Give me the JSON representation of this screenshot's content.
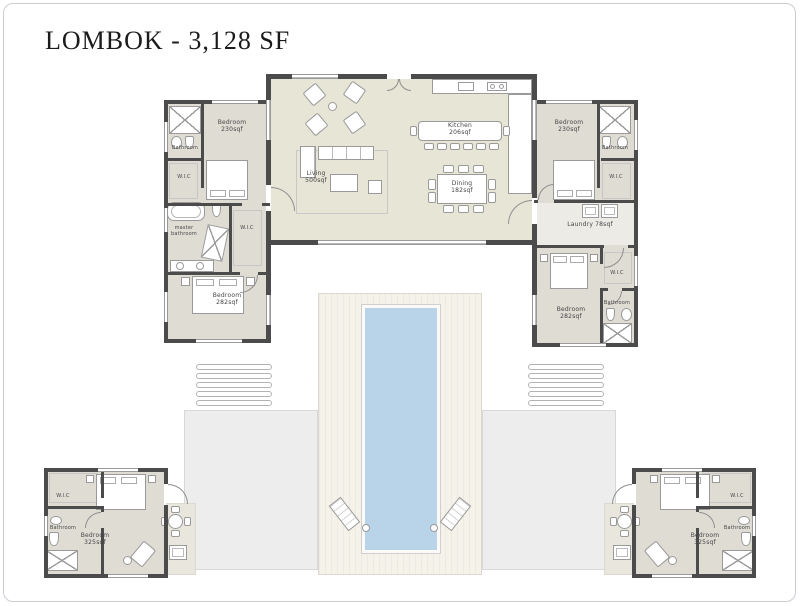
{
  "title": "LOMBOK - 3,128 SF",
  "colors": {
    "wall": "#4b4b4b",
    "great_room_floor": "#e6e5d6",
    "wing_floor": "#dfdcd4",
    "pool_water": "#b9d3e9",
    "deck": "#f5f2ea",
    "patio": "#ededed",
    "label_text": "#454545"
  },
  "rooms": {
    "bedroom_tl": {
      "name": "Bedroom",
      "area": "230sqf"
    },
    "bathroom_tl": {
      "name": "Bathroom"
    },
    "wic_tl": {
      "name": "W.I.C"
    },
    "master_bathroom": {
      "name": "master bathroom"
    },
    "wic_master": {
      "name": "W.I.C"
    },
    "bedroom_bl": {
      "name": "Bedroom",
      "area": "282sqf"
    },
    "living": {
      "name": "Living",
      "area": "500sqf"
    },
    "kitchen": {
      "name": "Kitchen",
      "area": "206sqf"
    },
    "dining": {
      "name": "Dining",
      "area": "182sqf"
    },
    "bedroom_tr": {
      "name": "Bedroom",
      "area": "230sqf"
    },
    "bathroom_tr": {
      "name": "Bathroom"
    },
    "wic_tr": {
      "name": "W.I.C"
    },
    "laundry": {
      "name": "Laundry",
      "area": "78sqf"
    },
    "bedroom_br": {
      "name": "Bedroom",
      "area": "282sqf"
    },
    "wic_br": {
      "name": "W.I.C"
    },
    "bathroom_br": {
      "name": "Bathroom"
    },
    "suite_left_bedroom": {
      "name": "Bedroom",
      "area": "325sqf"
    },
    "suite_left_bathroom": {
      "name": "Bathroom"
    },
    "suite_left_wic": {
      "name": "W.I.C"
    },
    "suite_right_bedroom": {
      "name": "Bedroom",
      "area": "325sqf"
    },
    "suite_right_bathroom": {
      "name": "Bathroom"
    },
    "suite_right_wic": {
      "name": "W.I.C"
    }
  }
}
